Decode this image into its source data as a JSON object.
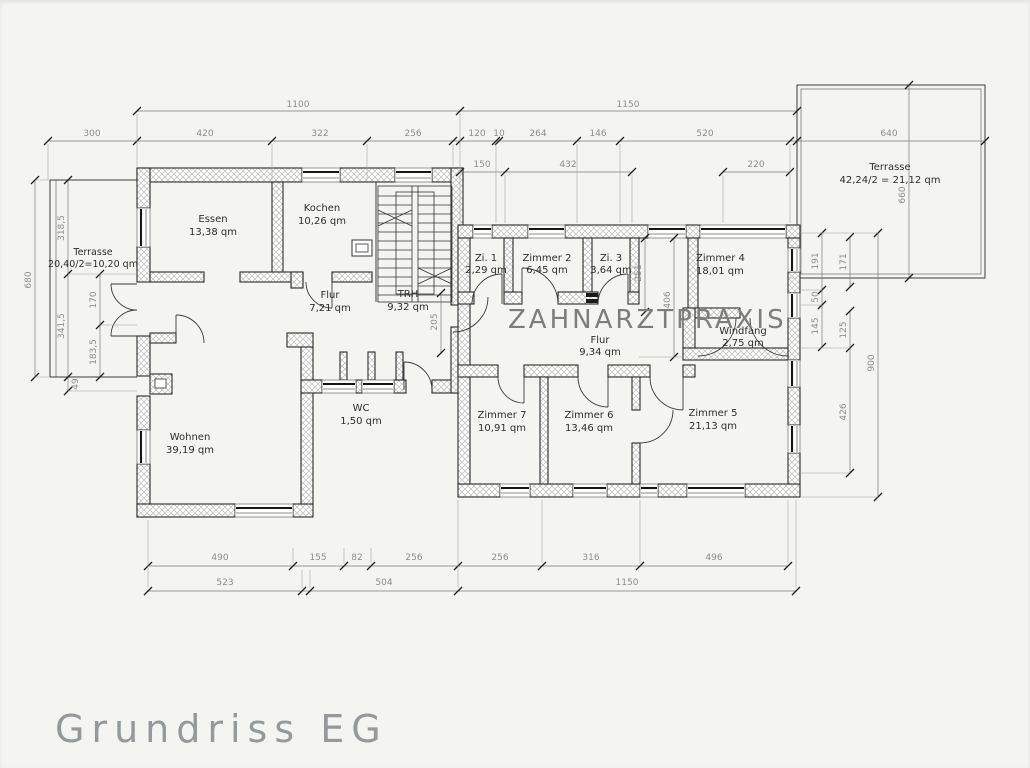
{
  "title": "Grundriss EG",
  "practice_label": "ZAHNARZTPRAXIS",
  "rooms": {
    "essen": {
      "name": "Essen",
      "area": "13,38 qm"
    },
    "kochen": {
      "name": "Kochen",
      "area": "10,26 qm"
    },
    "flur_left": {
      "name": "Flur",
      "area": "7,21 qm"
    },
    "trh": {
      "name": "TRH",
      "area": "9,32 qm"
    },
    "wohnen": {
      "name": "Wohnen",
      "area": "39,19 qm"
    },
    "wc": {
      "name": "WC",
      "area": "1,50 qm"
    },
    "zi1": {
      "name": "Zi. 1",
      "area": "2,29 qm"
    },
    "zimmer2": {
      "name": "Zimmer 2",
      "area": "6,45 qm"
    },
    "zi3": {
      "name": "Zi. 3",
      "area": "3,64 qm"
    },
    "zimmer4": {
      "name": "Zimmer 4",
      "area": "18,01 qm"
    },
    "windfang": {
      "name": "Windfang",
      "area": "2,75 qm"
    },
    "flur_right": {
      "name": "Flur",
      "area": "9,34 qm"
    },
    "zimmer7": {
      "name": "Zimmer 7",
      "area": "10,91 qm"
    },
    "zimmer6": {
      "name": "Zimmer 6",
      "area": "13,46 qm"
    },
    "zimmer5": {
      "name": "Zimmer 5",
      "area": "21,13 qm"
    },
    "terrasse_left": {
      "name": "Terrasse",
      "area": "20,40/2=10,20 qm"
    },
    "terrasse_right": {
      "name": "Terrasse",
      "area": "42,24/2 = 21,12 qm"
    }
  },
  "dims": {
    "top1": [
      "1100",
      "1150"
    ],
    "top2": [
      "300",
      "420",
      "322",
      "256",
      "120",
      "10",
      "264",
      "146",
      "520",
      "640"
    ],
    "top3": [
      "150",
      "432",
      "220"
    ],
    "bottom1": [
      "490",
      "155",
      "82",
      "256",
      "256",
      "316",
      "496"
    ],
    "bottom2": [
      "523",
      "504",
      "1150"
    ],
    "left": [
      "680",
      "318,5",
      "341,5",
      "170",
      "183,5",
      "49"
    ],
    "right": [
      "191",
      "50",
      "145",
      "171",
      "125",
      "426",
      "900",
      "660"
    ],
    "interior": [
      "205",
      "251",
      "406"
    ]
  }
}
